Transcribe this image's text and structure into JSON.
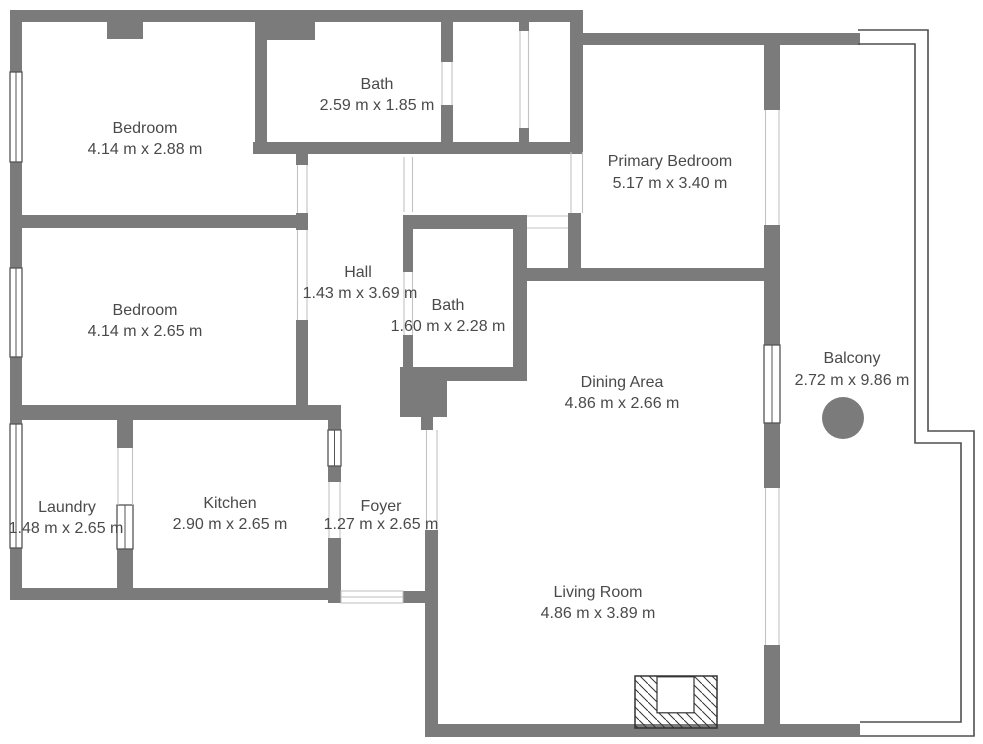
{
  "title": "Apartment floor plan",
  "colors": {
    "wall": "#7b7b7b",
    "text": "#4a4a4a",
    "railing_outline": "#4f4f4f",
    "window_outline": "#555555",
    "fireplace_outline": "#333333",
    "background": "#ffffff"
  },
  "rooms": {
    "bedroom1": {
      "name": "Bedroom",
      "dims": "4.14 m x 2.88 m"
    },
    "bath1": {
      "name": "Bath",
      "dims": "2.59 m x 1.85 m"
    },
    "primary": {
      "name": "Primary Bedroom",
      "dims": "5.17 m x 3.40 m"
    },
    "bedroom2": {
      "name": "Bedroom",
      "dims": "4.14 m x 2.65 m"
    },
    "hall": {
      "name": "Hall",
      "dims": "1.43 m x 3.69 m"
    },
    "bath2": {
      "name": "Bath",
      "dims": "1.60 m x 2.28 m"
    },
    "dining": {
      "name": "Dining Area",
      "dims": "4.86 m x 2.66 m"
    },
    "balcony": {
      "name": "Balcony",
      "dims": "2.72 m x 9.86 m"
    },
    "laundry": {
      "name": "Laundry",
      "dims": "1.48 m x 2.65 m"
    },
    "kitchen": {
      "name": "Kitchen",
      "dims": "2.90 m x 2.65 m"
    },
    "foyer": {
      "name": "Foyer",
      "dims": "1.27 m x 2.65 m"
    },
    "living": {
      "name": "Living Room",
      "dims": "4.86 m x 3.89 m"
    }
  }
}
